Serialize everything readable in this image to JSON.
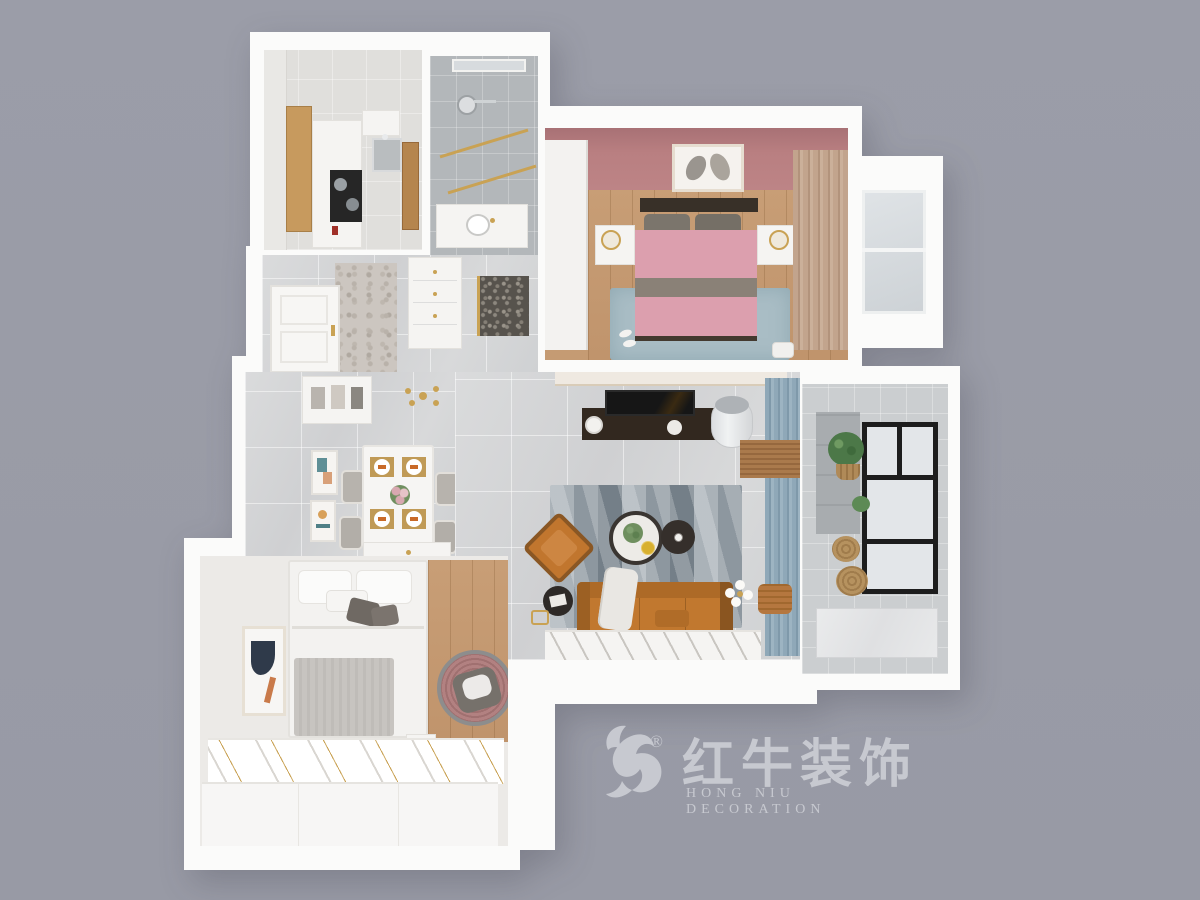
{
  "scene": {
    "type": "3d-floor-plan-render",
    "background_color": "#9a9ca7",
    "rooms": [
      {
        "id": "kitchen",
        "features": [
          "wood tall cabinet",
          "white cabinets",
          "black cooktop with pots",
          "steel sink",
          "wood door"
        ]
      },
      {
        "id": "bathroom",
        "features": [
          "gray tile",
          "rain shower head",
          "gold-framed glass screen",
          "white vanity",
          "slit window"
        ]
      },
      {
        "id": "master-bedroom",
        "features": [
          "pink accent wall",
          "feather art frame",
          "double bed pink duvet",
          "gray and yellow pillows",
          "two white nightstands with gold wire lamps",
          "white wardrobe",
          "tan curtains",
          "bay window",
          "blue-gray rug",
          "wood floor"
        ]
      },
      {
        "id": "entry-hall",
        "features": [
          "white paneled entry door with gold handle",
          "drawer cabinet with gold knobs",
          "patterned glass bathroom door",
          "mosaic floor strip"
        ]
      },
      {
        "id": "dining-area",
        "features": [
          "white dining table",
          "four gray chairs",
          "gold placemats with white plates and orange napkins",
          "flower centerpiece",
          "wall niche shelf",
          "two abstract art frames",
          "gold sputnik chandelier",
          "white sideboard"
        ]
      },
      {
        "id": "living-room",
        "features": [
          "cream tv feature wall",
          "dark walnut tv console",
          "flat tv",
          "white cylinder air conditioner",
          "blue curtains with wood blind",
          "geometric gray rug",
          "round marble coffee table with plant",
          "round dark side table",
          "orange leather sofa with white throw",
          "orange accent chair",
          "dark round magazine table",
          "gold floor lamp with white globes",
          "copper pouf"
        ]
      },
      {
        "id": "balcony",
        "features": [
          "black framed window",
          "green plants in woven baskets",
          "marble tile walls",
          "marble counter"
        ]
      },
      {
        "id": "second-bedroom",
        "features": [
          "white bed",
          "gray blanket",
          "dark gray pillows",
          "abstract art frame",
          "wood floor",
          "round rattan papasan chair",
          "white wardrobe with gold trim",
          "white low cabinet"
        ]
      }
    ]
  },
  "watermark": {
    "logo": "bull-swoosh",
    "registered": "®",
    "brand_cn": "红牛装饰",
    "brand_en": "HONG NIU DECORATION",
    "color": "#c7c9d0"
  },
  "palette": {
    "background": "#9a9ca7",
    "walls": "#fbfbfa",
    "pink_wall": "#b97f81",
    "duvet_pink": "#dc9fae",
    "pillow_yellow": "#d8a82c",
    "sofa_orange": "#c1782f",
    "curtain_blue": "#8fa8b8",
    "curtain_tan": "#c2a48d",
    "wood": "#c59b73",
    "gold": "#c9a254",
    "rug_blue_gray": "#a9bdc5"
  }
}
